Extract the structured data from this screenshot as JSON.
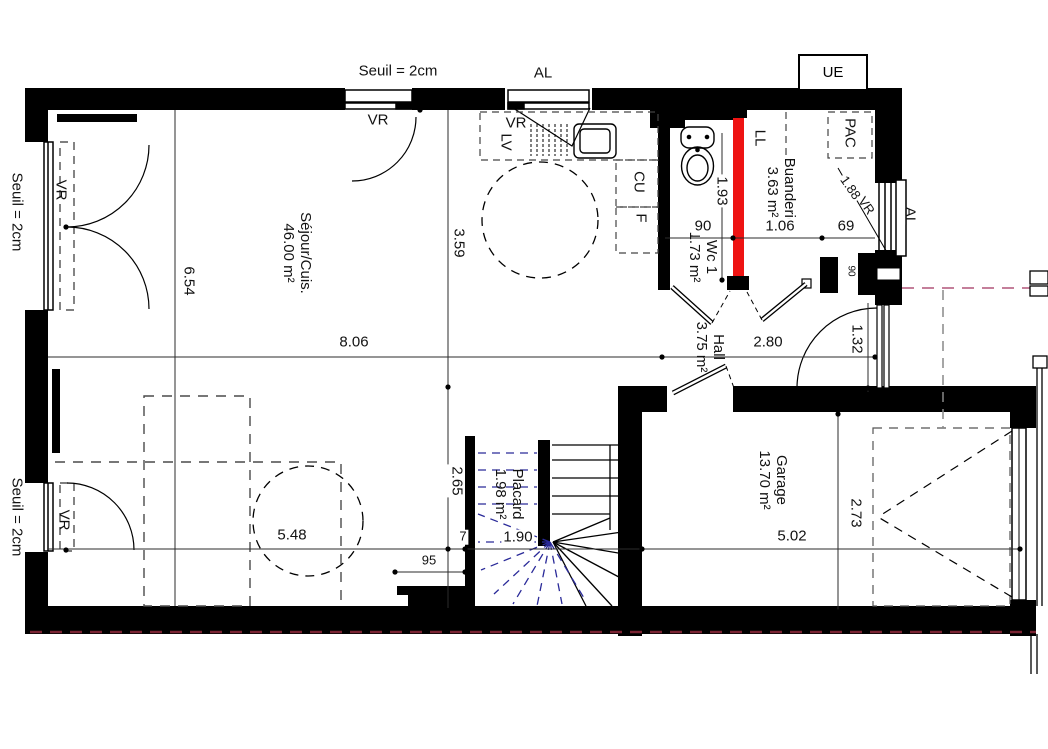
{
  "drawing_type": "architectural floor plan (rez-de-chaussée)",
  "colors": {
    "wall": "#000000",
    "highlighted_wall_red": "#ee1312",
    "stair_projection_blue": "#2a2a99",
    "site_boundary_maroon": "#7a2433",
    "furniture_dash_gray": "#4a4a4a"
  },
  "rooms": {
    "sejour": {
      "name": "Séjour/Cuis.",
      "area": "46.00 m²"
    },
    "wc": {
      "name": "Wc 1",
      "area": "1.73 m²"
    },
    "hall": {
      "name": "Hall",
      "area": "3.75 m²"
    },
    "buanderie": {
      "name": "Buanderie",
      "area": "3.63 m²"
    },
    "placard": {
      "name": "Placard",
      "area": "1.98 m²"
    },
    "garage": {
      "name": "Garage",
      "area": "13.70 m²"
    }
  },
  "equipment": {
    "ue": "UE",
    "pac": "PAC",
    "ll": "LL",
    "lv": "LV",
    "cu": "CU",
    "f": "F"
  },
  "openings": {
    "vr": "VR",
    "al": "AL",
    "seuil": "Seuil = 2cm"
  },
  "dimensions": {
    "d806": "8.06",
    "d280": "2.80",
    "d654": "6.54",
    "d359": "3.59",
    "d193": "1.93",
    "d90": "90",
    "d106": "1.06",
    "d69": "69",
    "d188": "1.88",
    "d132": "1.32",
    "d265": "2.65",
    "d7": "7",
    "d190": "1.90",
    "d548": "5.48",
    "d95": "95",
    "d502": "5.02",
    "d273": "2.73"
  }
}
